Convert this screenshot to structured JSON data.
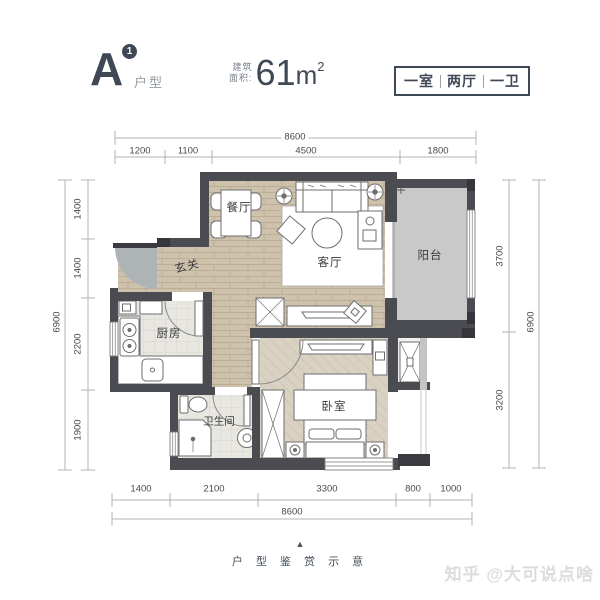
{
  "header": {
    "unit_letter": "A",
    "unit_badge": "1",
    "unit_type_label": "户型",
    "area_label_line1": "建筑",
    "area_label_line2": "面积:",
    "area_value": "61",
    "area_unit": "m",
    "area_exponent": "2",
    "layout_tags": [
      "一室",
      "两厅",
      "一卫"
    ]
  },
  "rooms": {
    "dining": "餐厅",
    "living": "客厅",
    "balcony": "阳台",
    "entry": "玄关",
    "kitchen": "厨房",
    "bathroom": "卫生间",
    "bedroom": "卧室"
  },
  "dimensions": {
    "top": {
      "total": "8600",
      "segments": [
        "1200",
        "1100",
        "4500",
        "1800"
      ]
    },
    "bottom": {
      "total": "8600",
      "segments": [
        "1400",
        "2100",
        "3300",
        "800",
        "1000"
      ]
    },
    "left": {
      "total": "6900",
      "segments": [
        "1400",
        "1400",
        "2200",
        "1900"
      ]
    },
    "right": {
      "total": "6900",
      "segments": [
        "3700",
        "3200"
      ]
    }
  },
  "footer": {
    "pointer_icon": "▲",
    "caption": "户 型 鉴 赏 示 意"
  },
  "watermark": "知乎 @大可说点啥",
  "colors": {
    "accent": "#3f4956",
    "wall": "#4b4b52",
    "wood_floor": "#cec2ad",
    "balcony_floor": "#c9c9c9",
    "bedroom_floor": "#d9d1c2",
    "dim_text": "#4a4a4a",
    "watermark": "#dcdcdc"
  }
}
